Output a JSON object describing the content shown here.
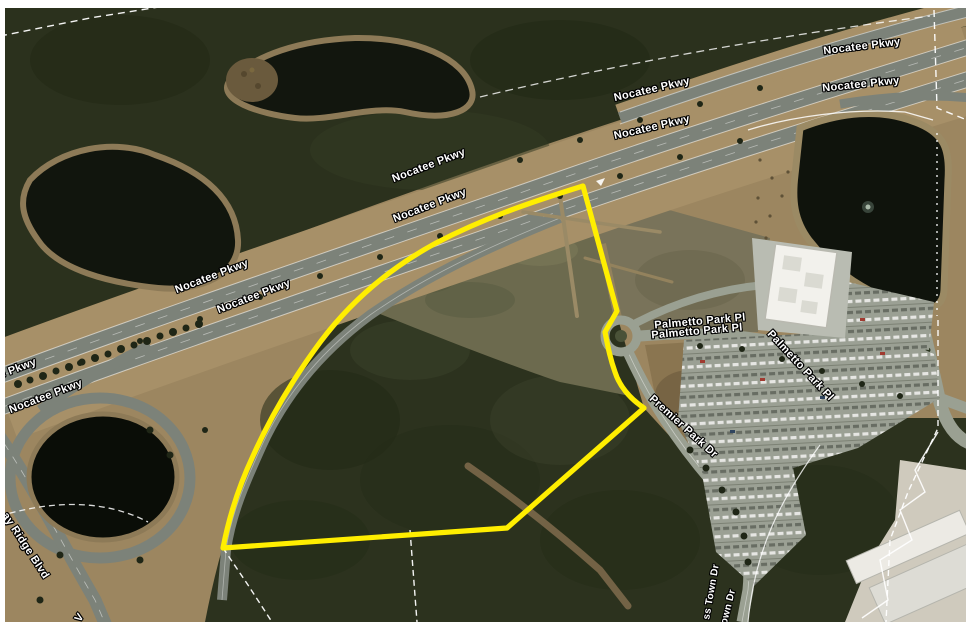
{
  "map": {
    "description_of_view": "aerial satellite view with highlighted parcel",
    "road_labels": {
      "nocatee_pkwy": "Nocatee Pkwy",
      "nocatee_pkwy_partial": "e Pkwy",
      "palmetto_park_pl": "Palmetto Park Pl",
      "premier_park_dr": "Premier Park Dr",
      "ridge_blvd_partial": "ay Ridge Blvd",
      "town_dr_partial_left": "ss Town Dr",
      "town_dr_partial_right": "own Dr",
      "blvd_partial_bottom": "V"
    },
    "colors": {
      "parcel_outline": "#ffee00",
      "parcel_boundary_lines": "#ffffff",
      "road_label_text": "#ffffff",
      "frame": "#ffffff",
      "water": "#10140d",
      "forest": "#2c321e",
      "grass": "#9c8660",
      "road": "#7c8279"
    }
  }
}
